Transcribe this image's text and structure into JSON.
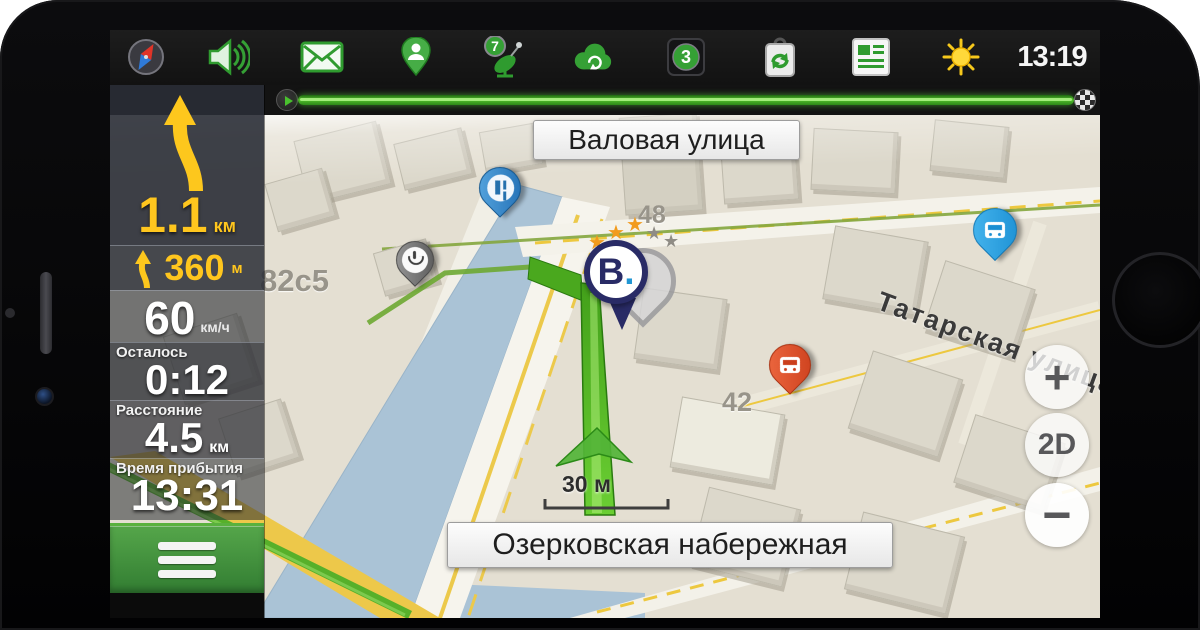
{
  "status_bar": {
    "icons": [
      "compass-icon",
      "volume-icon",
      "mail-icon",
      "driver-pin-icon",
      "satellite-icon",
      "cloud-sync-icon",
      "traffic-score-badge",
      "services-sync-icon",
      "news-icon",
      "weather-sun-icon"
    ],
    "satellite_count": "7",
    "traffic_score": "3",
    "time": "13:19"
  },
  "sidebar": {
    "maneuver": {
      "distance": "1.1",
      "unit": "км"
    },
    "maneuver2": {
      "distance": "360",
      "unit": "м"
    },
    "speed": {
      "value": "60",
      "unit": "км/ч"
    },
    "remaining": {
      "label": "Осталось",
      "value": "0:12"
    },
    "distance": {
      "label": "Расстояние",
      "value": "4.5",
      "unit": "км"
    },
    "arrival": {
      "label": "Время прибытия",
      "value": "13:31"
    }
  },
  "map": {
    "streets": {
      "top": "Валовая улица",
      "bottom": "Озерковская набережная",
      "right": "Татарская улица"
    },
    "houses": {
      "h1": "82с5",
      "h2": "48",
      "h3": "42"
    },
    "scale": "30 м",
    "destination": {
      "letter": "B",
      "dot": "."
    },
    "controls": {
      "zoom_in": "+",
      "mode": "2D",
      "zoom_out": "−"
    },
    "markers": [
      "monument-pin",
      "pharmacy-pin",
      "bus-stop-pin",
      "tram-stop-pin",
      "destination-pin"
    ]
  },
  "colors": {
    "accent_green": "#35a035",
    "accent_yellow": "#ffc61e",
    "route_green": "#54c22d",
    "water": "#aac3d6",
    "destination_navy": "#292b66",
    "bus_blue": "#2aa6e4",
    "tram_orange": "#e4583a",
    "monument_blue": "#2f83c4"
  }
}
